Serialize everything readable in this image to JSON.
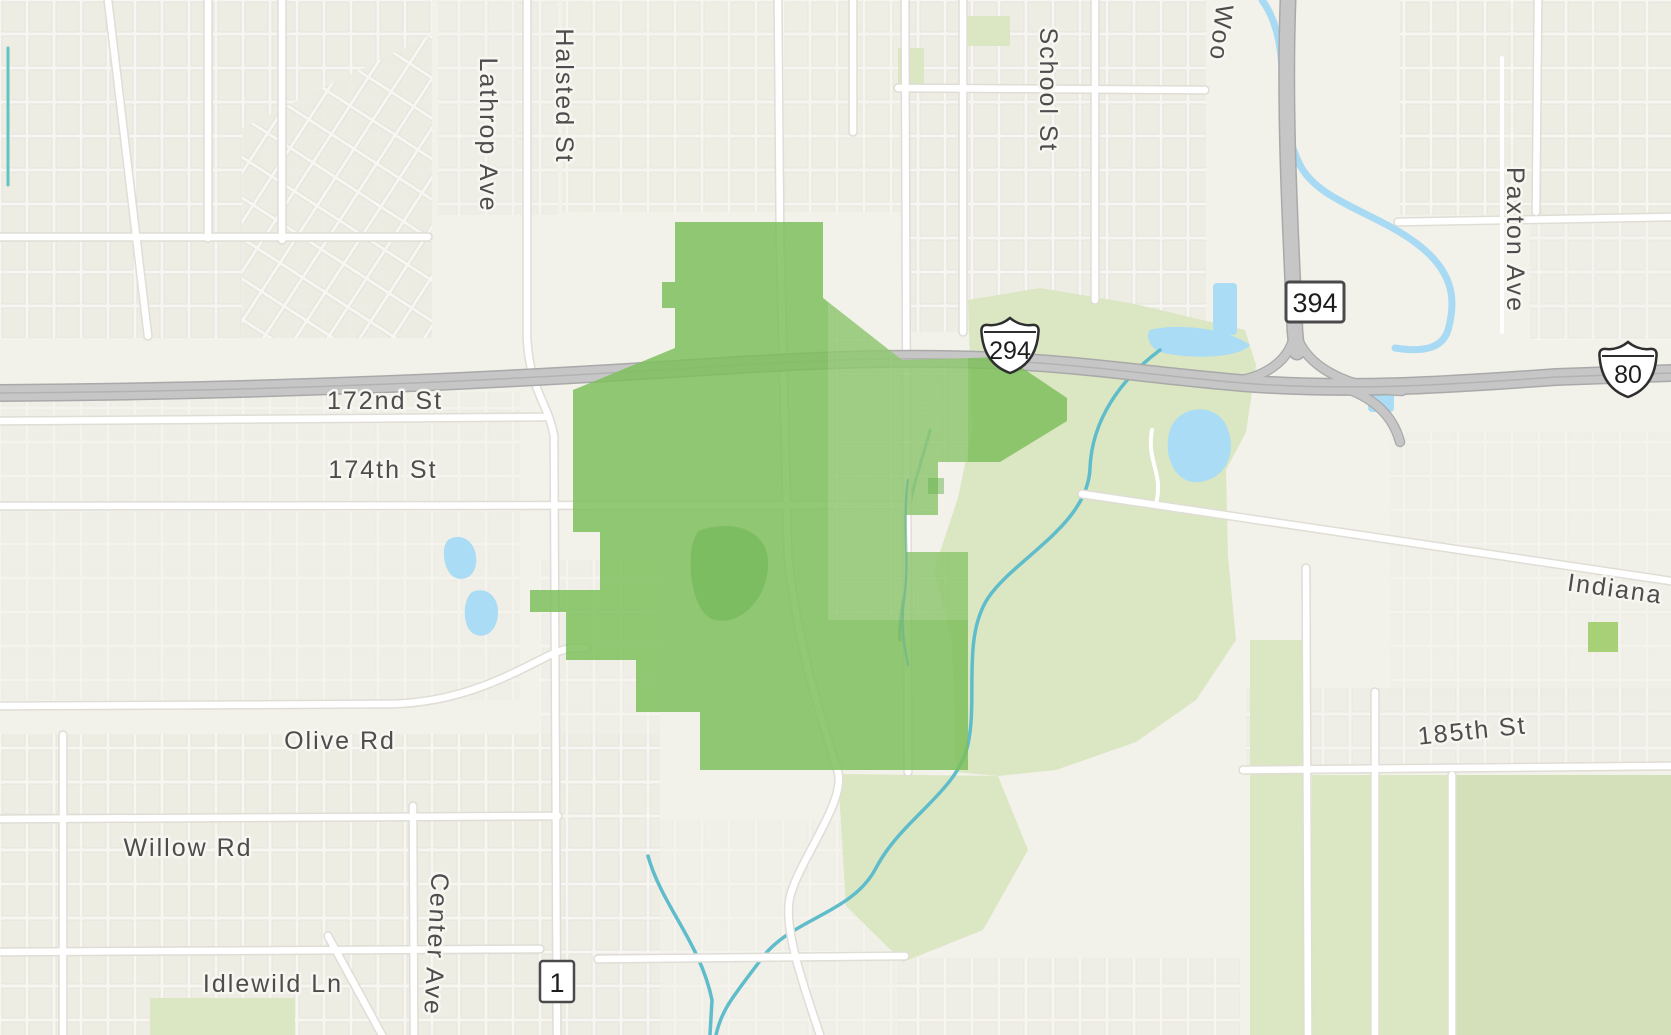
{
  "map": {
    "description_labels": {
      "halsted_st": "Halsted St",
      "lathrop_ave": "Lathrop Ave",
      "school_st": "School St",
      "wood_partial": "Woo",
      "paxton_ave": "Paxton Ave",
      "st_172nd": "172nd St",
      "st_174th": "174th St",
      "indiana": "Indiana",
      "st_185th": "185th St",
      "olive_rd": "Olive Rd",
      "willow_rd": "Willow Rd",
      "center_ave": "Center Ave",
      "idlewild_ln": "Idlewild Ln"
    },
    "shields": {
      "i294": "294",
      "i80": "80",
      "il394": "394",
      "il1": "1"
    },
    "colors": {
      "land": "#f2f1ea",
      "residential_block": "#edece3",
      "residential_street": "#f8f7f3",
      "road_white": "#ffffff",
      "road_casing": "#dfddd5",
      "highway_fill": "#c6c6c6",
      "highway_casing": "#a9a9a9",
      "park": "#dbe6c3",
      "park_alt": "#d3e0ba",
      "park_square": "#a8d077",
      "water": "#aadcf5",
      "river": "#a8daf4",
      "stream": "#5fbccb",
      "canal": "#63c3c3",
      "boundary_fill": "#7dbf5b",
      "boundary_park_fill": "#69b44f",
      "label_text": "#4d4d4d"
    }
  }
}
